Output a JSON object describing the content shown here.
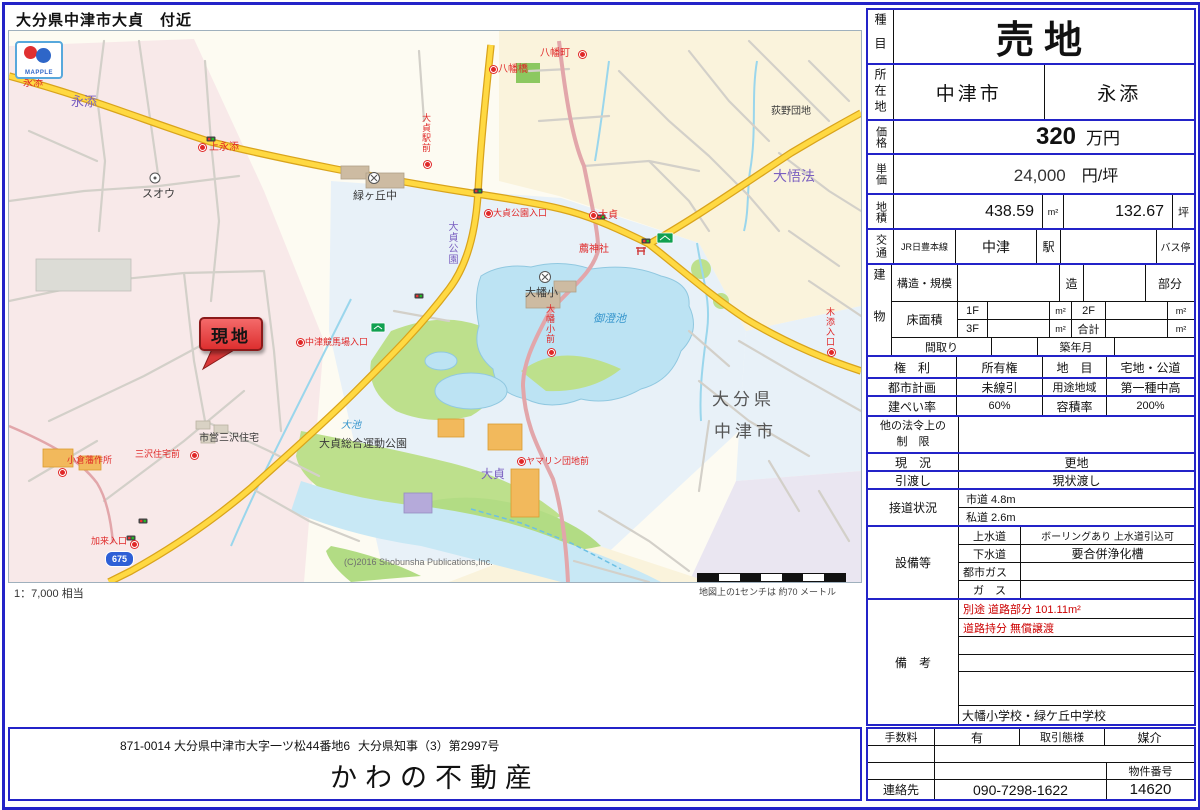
{
  "page": {
    "title": "大分県中津市大貞　付近"
  },
  "map": {
    "logo": "MAPPLE",
    "site_marker": "現地",
    "route_shield": "675",
    "scale_ratio": "1：7,000 相当",
    "scale_note": "地図上の1センチは 約70 メートル",
    "copyright": "(C)2016 Shobunsha Publications,Inc.",
    "labels": {
      "nagasoe_purple": "永添",
      "nagasoe_bus": "永添",
      "kaminagasoe": "上永添",
      "suou": "スオウ",
      "midorigaoka_jhs": "緑ヶ丘中",
      "hachimancho": "八幡町",
      "hachimanbashi": "八幡橋",
      "ogino_danchi": "荻野団地",
      "daigobo": "大悟法",
      "osada_ekimae": "大貞駅前",
      "osada_koen_iriguchi": "大貞公園入口",
      "osada_bus": "大貞",
      "osada_koen": "大貞公園",
      "komo_jinja": "薦神社",
      "misumi_ike": "御澄池",
      "ohata_sho": "大幡小",
      "ohata_sho_mae": "大幡小前",
      "oita_ken": "大分県",
      "nakatsu_shi": "中津市",
      "osada_purple": "大貞",
      "yamarin_danchi_mae": "ヤマリン団地前",
      "shiei_misawa_jutaku": "市営三沢住宅",
      "osada_sogo_undo_koen": "大貞総合運動公園",
      "oike": "大池",
      "nakatsu_keibajo_iriguchi": "中津競馬場入口",
      "misawa_jutaku_mae": "三沢住宅前",
      "kokura_han_sakusho": "小倉藩作所",
      "kaku_iriguchi": "加来入口",
      "kizoe_iriguchi": "木添入口"
    }
  },
  "property": {
    "category_label": "種目",
    "category": "売地",
    "location_label": "所在地",
    "city": "中津市",
    "district": "永添",
    "price_label": "価格",
    "price": "320",
    "price_unit": "万円",
    "unit_price_label": "単価",
    "unit_price": "24,000",
    "unit_price_unit": "円/坪",
    "land_area_label": "地積",
    "land_area_sqm": "438.59",
    "sqm_unit": "m²",
    "land_area_tsubo": "132.67",
    "tsubo_unit": "坪",
    "transport_label": "交通",
    "rail_line": "JR日豊本線",
    "station": "中津",
    "station_suffix": "駅",
    "bus_stop_label": "バス停",
    "building_label": "建物",
    "structure_label": "構造・規模",
    "structure_suffix": "造",
    "part_label": "部分",
    "floor_area_label": "床面積",
    "f1": "1F",
    "f2": "2F",
    "f3": "3F",
    "total_label": "合計",
    "madori_label": "間取り",
    "built_label": "築年月",
    "rights_label": "権　利",
    "rights": "所有権",
    "land_category_label": "地　目",
    "land_category": "宅地・公道",
    "city_planning_label": "都市計画",
    "city_planning": "未線引",
    "zoning_label": "用途地域",
    "zoning": "第一種中高",
    "bcr_label": "建ぺい率",
    "bcr": "60%",
    "far_label": "容積率",
    "far": "200%",
    "other_laws_label_1": "他の法令上の",
    "other_laws_label_2": "制　限",
    "current_state_label": "現　況",
    "current_state": "更地",
    "handover_label": "引渡し",
    "handover": "現状渡し",
    "road_access_label": "接道状況",
    "road_access_1": "市道  4.8m",
    "road_access_2": "私道  2.6m",
    "facilities_label": "設備等",
    "water_label": "上水道",
    "water": "ボーリングあり 上水道引込可",
    "sewer_label": "下水道",
    "sewer": "要合併浄化槽",
    "city_gas_label": "都市ガス",
    "gas_label": "ガ　ス",
    "remarks_label": "備　考",
    "remark_red_1": "別途  道路部分      101.11m²",
    "remark_red_2": "道路持分    無償譲渡",
    "remark_schools": "大幡小学校・緑ケ丘中学校"
  },
  "deal": {
    "fee_label": "手数料",
    "fee": "有",
    "transaction_type_label": "取引態様",
    "transaction_type": "媒介",
    "property_no_label": "物件番号",
    "property_no": "14620",
    "contact_label": "連絡先",
    "phone": "090-7298-1622"
  },
  "footer": {
    "address": "871-0014  大分県中津市大字一ツ松44番地6",
    "license": "大分県知事（3）第2997号",
    "company": "かわの不動産"
  }
}
